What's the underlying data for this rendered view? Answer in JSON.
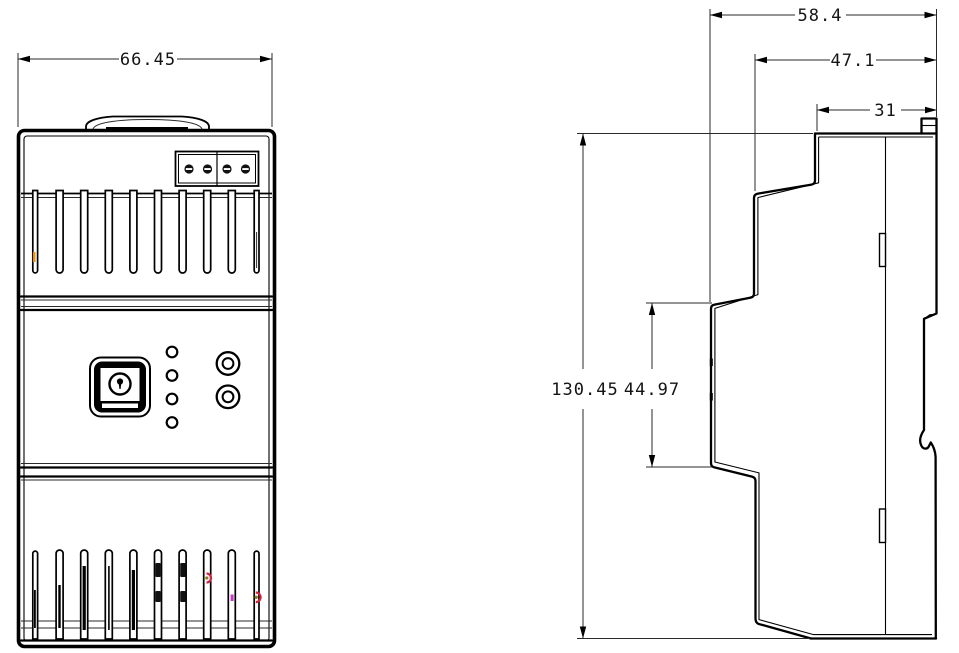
{
  "drawing": {
    "background": "#ffffff",
    "stroke_color": "#000000",
    "views": {
      "front": {
        "name": "front-view"
      },
      "side": {
        "name": "side-view"
      }
    },
    "dimensions": {
      "front_width": "66.45",
      "side_total_depth": "58.4",
      "side_body_depth": "47.1",
      "side_front_depth": "31",
      "side_total_height": "130.45",
      "side_mid_section_height": "44.97"
    },
    "accents": {
      "orange_indicator": "#ED9200",
      "red_indicator": "#D02540",
      "magenta_indicator": "#C43BC4",
      "olive_indicator": "#8A7A1E"
    }
  }
}
